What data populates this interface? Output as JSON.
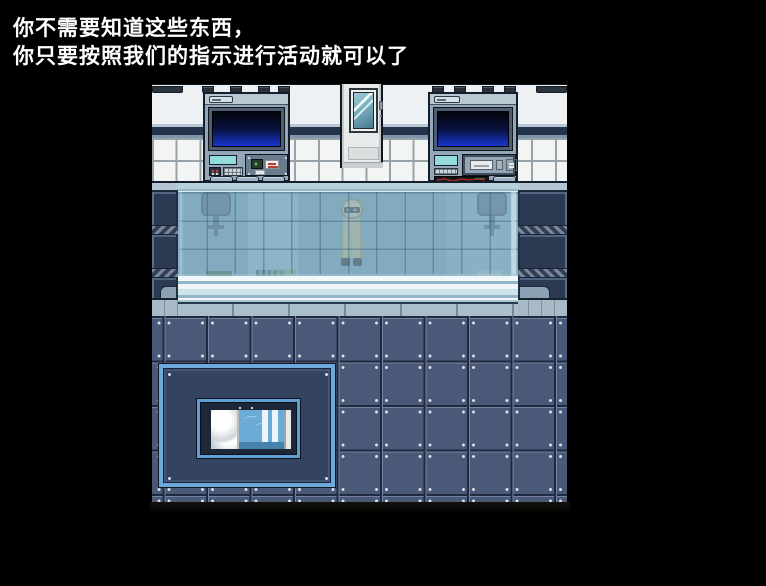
{
  "dialogue": {
    "line1": "你不需要知道这些东西，",
    "line2": "你只要按照我们的指示进行活动就可以了"
  },
  "scene": {
    "type": "pixel-art sci-fi laboratory room",
    "objects": [
      "left-control-console",
      "right-control-console",
      "door-with-window",
      "observation-glass-tank",
      "hazmat-suited-figure",
      "hanging-lamp-left",
      "hanging-lamp-right",
      "wall-pillar-left",
      "wall-pillar-right",
      "tiled-floor",
      "floor-mat",
      "bed-with-blue-blanket",
      "white-pillow"
    ],
    "colors": {
      "background": "#000000",
      "text": "#ffffff",
      "monitor_blue": "#1a35cf",
      "console_body": "#93a7b8",
      "glass_blue": "#8cb4c8",
      "wall_white": "#f0f3f4",
      "floor_tile": "#4b5979",
      "mat_fill": "#344360",
      "mat_border": "#6fa9da",
      "blanket_blue": "#6cabd5",
      "pillar_navy": "#32415d"
    }
  }
}
